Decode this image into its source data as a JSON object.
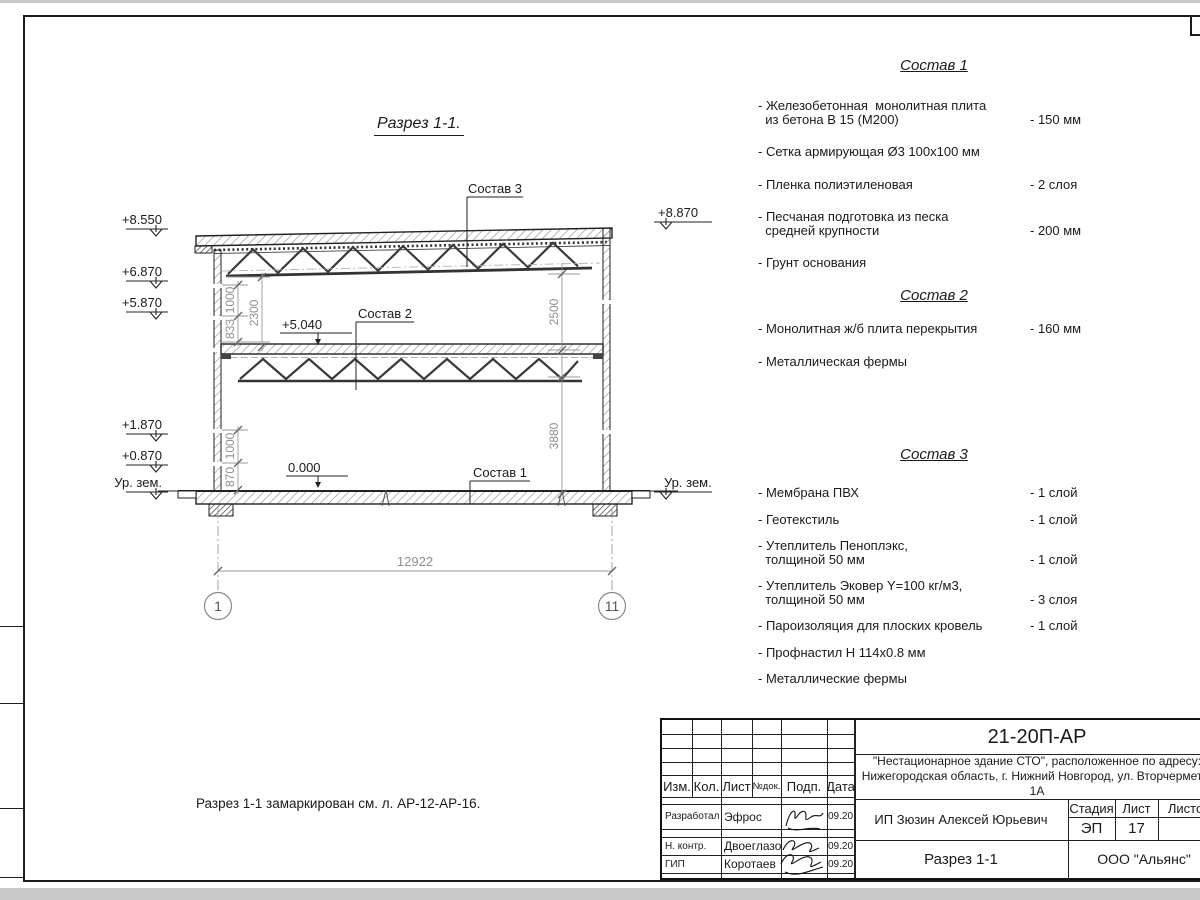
{
  "colors": {
    "line": "#1a1a1a",
    "dim": "#8f8f8f"
  },
  "drawing": {
    "title": "Разрез 1-1.",
    "note": "Разрез 1-1 замаркирован см. л. АР-12-АР-16.",
    "labels": {
      "sostav1": "Состав 1",
      "sostav2": "Состав 2",
      "sostav3": "Состав 3",
      "elev_roof_left": "+8.550",
      "elev_truss_left": "+6.870",
      "elev_mid_left": "+5.870",
      "elev_low1_left": "+1.870",
      "elev_low2_left": "+0.870",
      "ground_left": "Ур. зем.",
      "elev_roof_right": "+8.870",
      "ground_right": "Ур. зем.",
      "elev_mid_slab": "+5.040",
      "elev_zero": "0.000"
    },
    "dims": {
      "upper_1000": "1000",
      "upper_833": "833",
      "upper_2300": "2300",
      "right_2500": "2500",
      "right_3880": "3880",
      "lower_1000": "1000",
      "lower_870": "870",
      "total": "12922"
    },
    "grid": {
      "left": "1",
      "right": "11"
    }
  },
  "compositions": [
    {
      "title": "Состав 1",
      "items": [
        {
          "name": "- Железобетонная  монолитная плита\n  из бетона В 15 (М200)",
          "value": "- 150 мм"
        },
        {
          "name": "- Сетка армирующая Ø3 100х100 мм",
          "value": ""
        },
        {
          "name": "- Пленка полиэтиленовая",
          "value": "-  2 слоя"
        },
        {
          "name": "- Песчаная подготовка из песка\n  средней крупности",
          "value": "- 200 мм"
        },
        {
          "name": "- Грунт основания",
          "value": ""
        }
      ]
    },
    {
      "title": "Состав 2",
      "items": [
        {
          "name": "- Монолитная ж/б плита перекрытия",
          "value": "- 160 мм"
        },
        {
          "name": "- Металлическая фермы",
          "value": ""
        }
      ]
    },
    {
      "title": "Состав 3",
      "items": [
        {
          "name": "- Мембрана ПВХ",
          "value": "- 1 слой"
        },
        {
          "name": "- Геотекстиль",
          "value": "- 1 слой"
        },
        {
          "name": "- Утеплитель Пеноплэкс,\n  толщиной 50 мм",
          "value": "- 1 слой"
        },
        {
          "name": "- Утеплитель Эковер Y=100 кг/м3,\n  толщиной 50 мм",
          "value": "- 3 слоя"
        },
        {
          "name": "- Пароизоляция для плоских кровель",
          "value": "- 1 слой"
        },
        {
          "name": "- Профнастил Н 114х0.8 мм",
          "value": ""
        },
        {
          "name": "- Металлические фермы",
          "value": ""
        }
      ]
    }
  ],
  "titleblock": {
    "doc_number": "21-20П-АР",
    "project_line1": "\"Нестационарное здание СТО\", расположенное по адресу:",
    "project_line2": "Нижегородская область, г. Нижний Новгород, ул. Вторчермета, 1А",
    "client": "ИП Зюзин Алексей Юрьевич",
    "sheet_name": "Разрез 1-1",
    "company": "ООО \"Альянс\"",
    "stage_label": "Стадия",
    "sheet_label": "Лист",
    "sheets_label": "Листов",
    "stage": "ЭП",
    "sheet_number": "17",
    "sheets_total": "",
    "columns": {
      "izm": "Изм.",
      "kol": "Кол.",
      "list": "Лист",
      "doc": "№док.",
      "sign": "Подп.",
      "date": "Дата"
    },
    "rows": [
      {
        "role": "Разработал",
        "name": "Эфрос",
        "date": "09.20"
      },
      {
        "role": "Н. контр.",
        "name": "Двоеглазов",
        "date": "09.20"
      },
      {
        "role": "ГИП",
        "name": "Коротаев",
        "date": "09.20"
      }
    ]
  }
}
